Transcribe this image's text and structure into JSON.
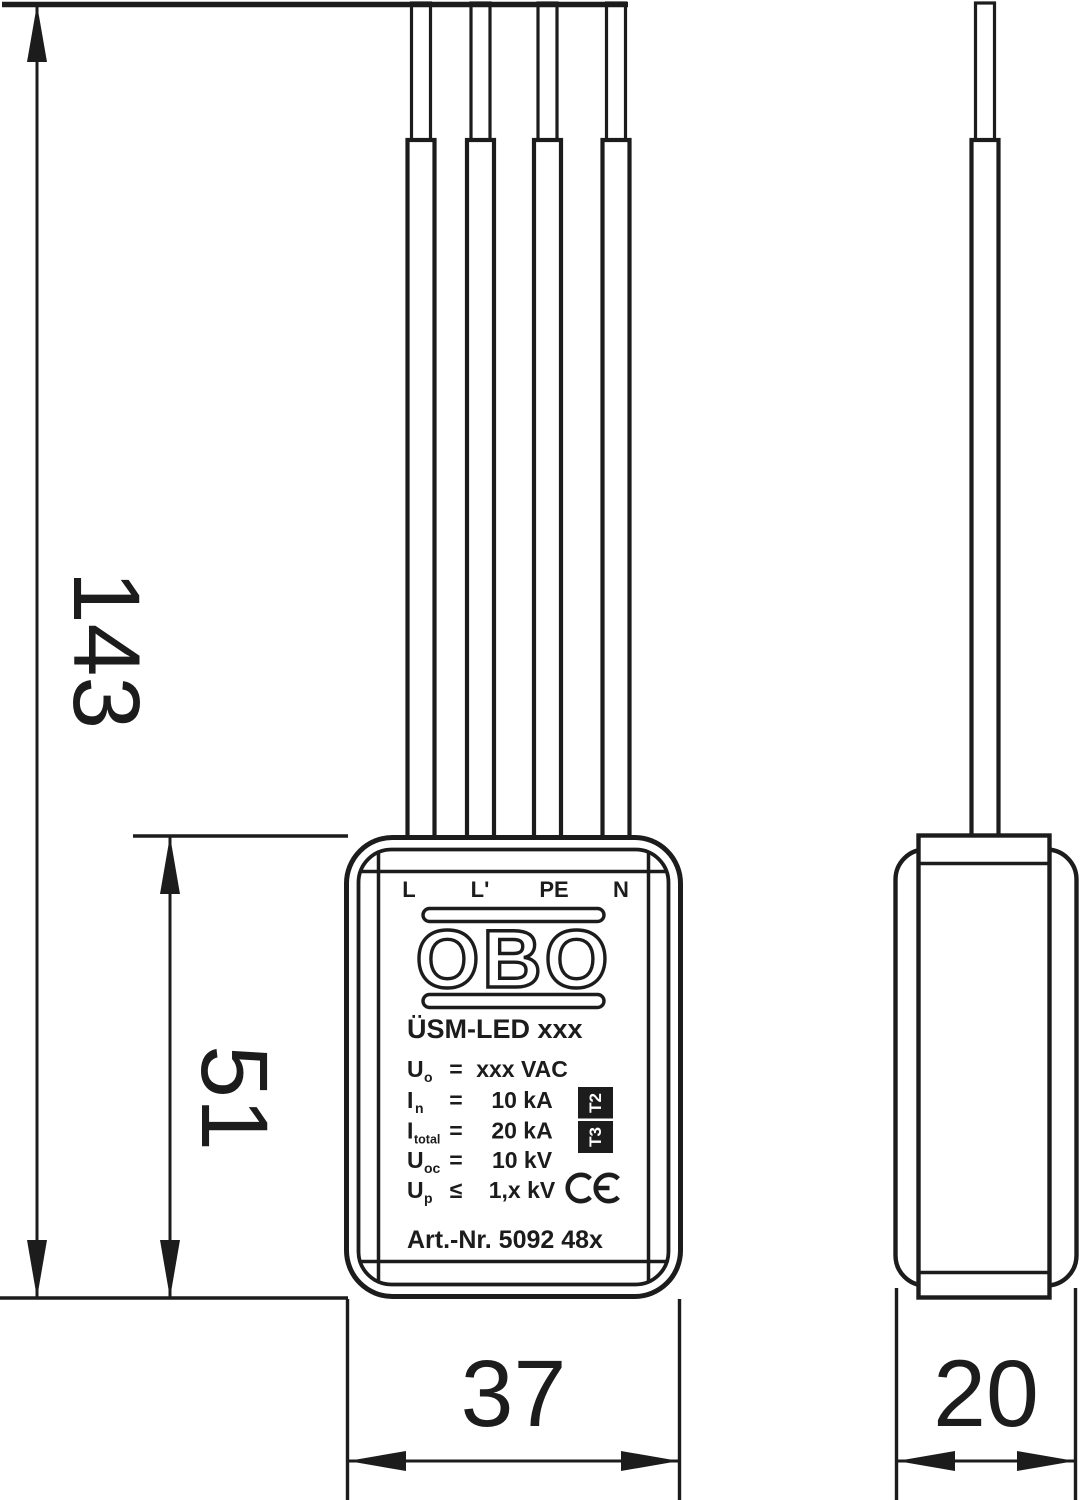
{
  "front_view": {
    "terminals": [
      "L",
      "L'",
      "PE",
      "N"
    ],
    "brand": "OBO",
    "model": "ÜSM-LED xxx",
    "specs": [
      {
        "sym": "U",
        "sub": "o",
        "op": "=",
        "value": "xxx VAC"
      },
      {
        "sym": "I",
        "sub": "n",
        "op": "=",
        "value": "10 kA"
      },
      {
        "sym": "I",
        "sub": "total",
        "op": "=",
        "value": "20 kA"
      },
      {
        "sym": "U",
        "sub": "oc",
        "op": "=",
        "value": "10 kV"
      },
      {
        "sym": "U",
        "sub": "p",
        "op": "≤",
        "value": "1,x kV"
      }
    ],
    "type_badges": [
      "T2",
      "T3"
    ],
    "ce_mark": "CE",
    "art_no": "Art.-Nr. 5092 48x"
  },
  "dimensions_mm": {
    "total_height": "143",
    "body_height": "51",
    "body_width": "37",
    "body_depth": "20"
  },
  "colors": {
    "line": "#1c1c1c",
    "background": "#ffffff"
  }
}
